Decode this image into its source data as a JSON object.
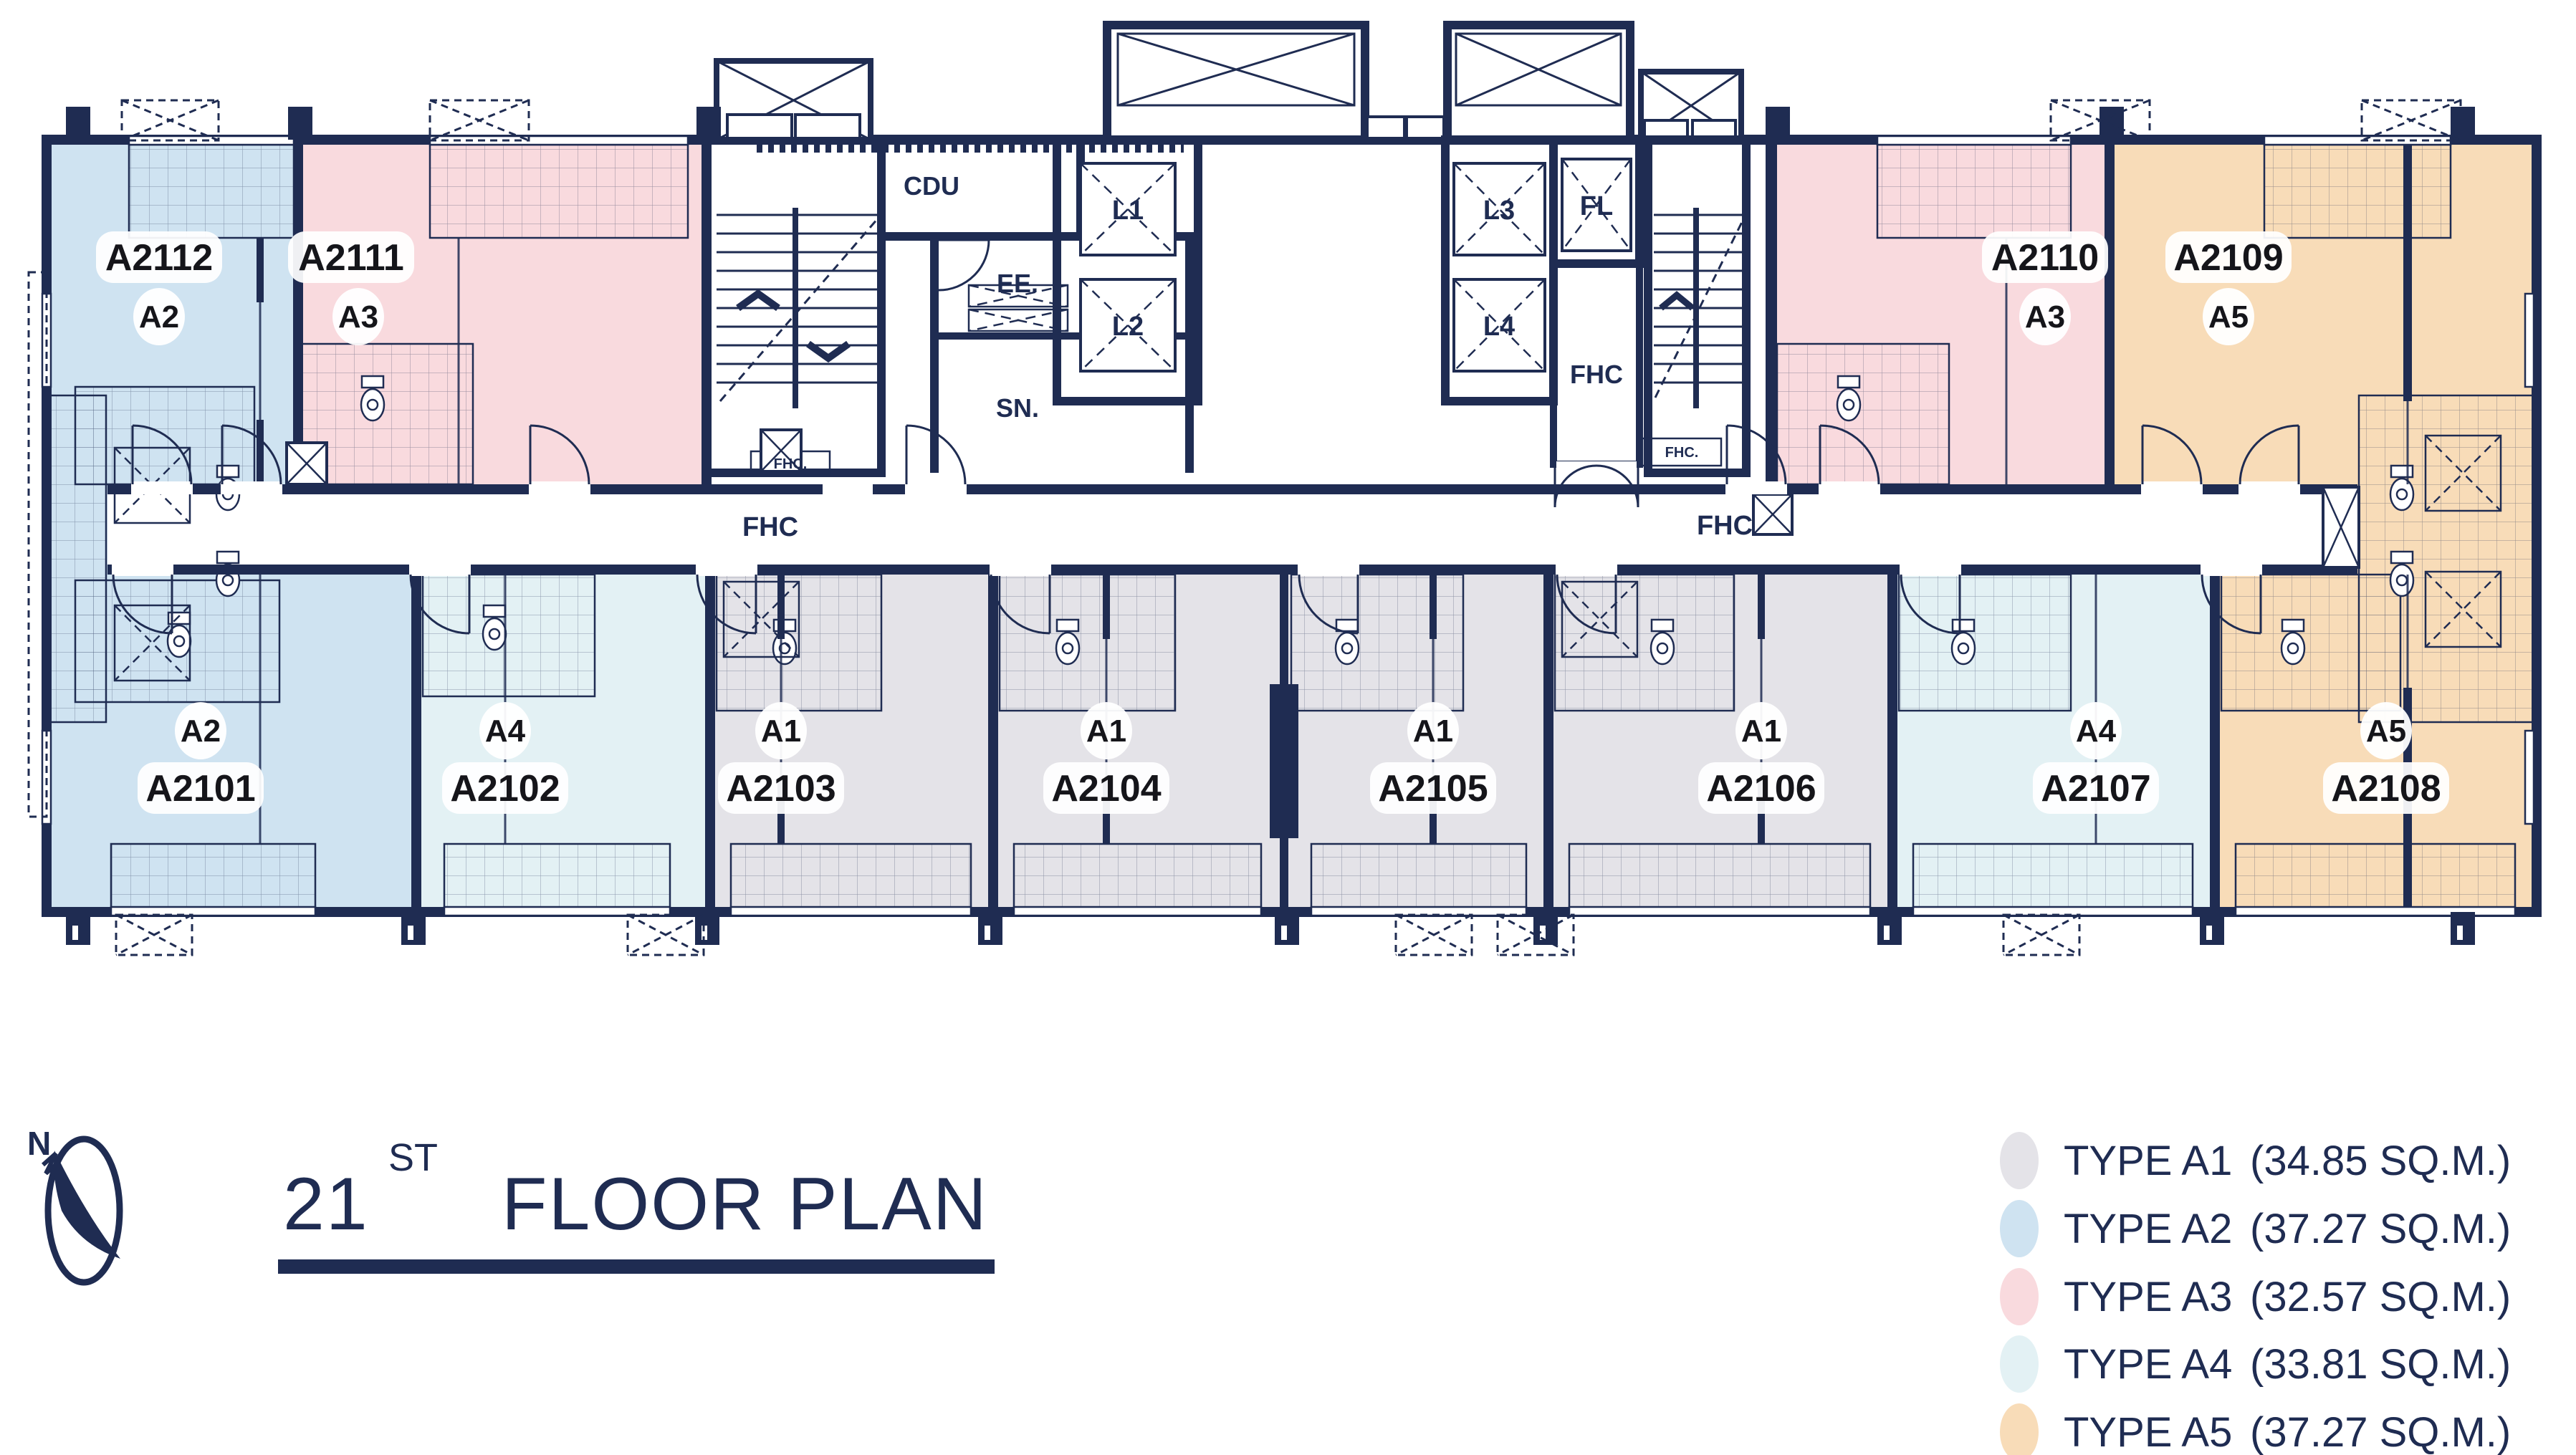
{
  "title": {
    "number": "21",
    "ordinal": "ST",
    "text": "FLOOR PLAN"
  },
  "compass": {
    "north": "N"
  },
  "corridor": {
    "fhc_left": "FHC",
    "fhc_right": "FHC"
  },
  "core": {
    "cdu": "CDU",
    "ee": "EE.",
    "sn": "SN.",
    "l1": "L1",
    "l2": "L2",
    "l3": "L3",
    "l4": "L4",
    "fl": "FL",
    "fhc_room": "FHC",
    "fhc_cabinet": "FHC."
  },
  "units": [
    {
      "id": "A2112",
      "type": "A2",
      "color": "#cfe3f1"
    },
    {
      "id": "A2111",
      "type": "A3",
      "color": "#f9dade"
    },
    {
      "id": "A2110",
      "type": "A3",
      "color": "#f9dade"
    },
    {
      "id": "A2109",
      "type": "A5",
      "color": "#f8dcb8"
    },
    {
      "id": "A2101",
      "type": "A2",
      "color": "#cfe3f1"
    },
    {
      "id": "A2102",
      "type": "A4",
      "color": "#e3f1f4"
    },
    {
      "id": "A2103",
      "type": "A1",
      "color": "#e4e3e8"
    },
    {
      "id": "A2104",
      "type": "A1",
      "color": "#e4e3e8"
    },
    {
      "id": "A2105",
      "type": "A1",
      "color": "#e4e3e8"
    },
    {
      "id": "A2106",
      "type": "A1",
      "color": "#e4e3e8"
    },
    {
      "id": "A2107",
      "type": "A4",
      "color": "#e3f1f4"
    },
    {
      "id": "A2108",
      "type": "A5",
      "color": "#f8dcb8"
    }
  ],
  "legend": {
    "items": [
      {
        "label": "TYPE A1",
        "area": "(34.85 SQ.M.)",
        "color": "#e4e3e8"
      },
      {
        "label": "TYPE A2",
        "area": "(37.27 SQ.M.)",
        "color": "#cfe3f1"
      },
      {
        "label": "TYPE A3",
        "area": "(32.57 SQ.M.)",
        "color": "#f9dade"
      },
      {
        "label": "TYPE A4",
        "area": "(33.81 SQ.M.)",
        "color": "#e3f1f4"
      },
      {
        "label": "TYPE A5",
        "area": "(37.27 SQ.M.)",
        "color": "#f8dcb8"
      }
    ]
  }
}
